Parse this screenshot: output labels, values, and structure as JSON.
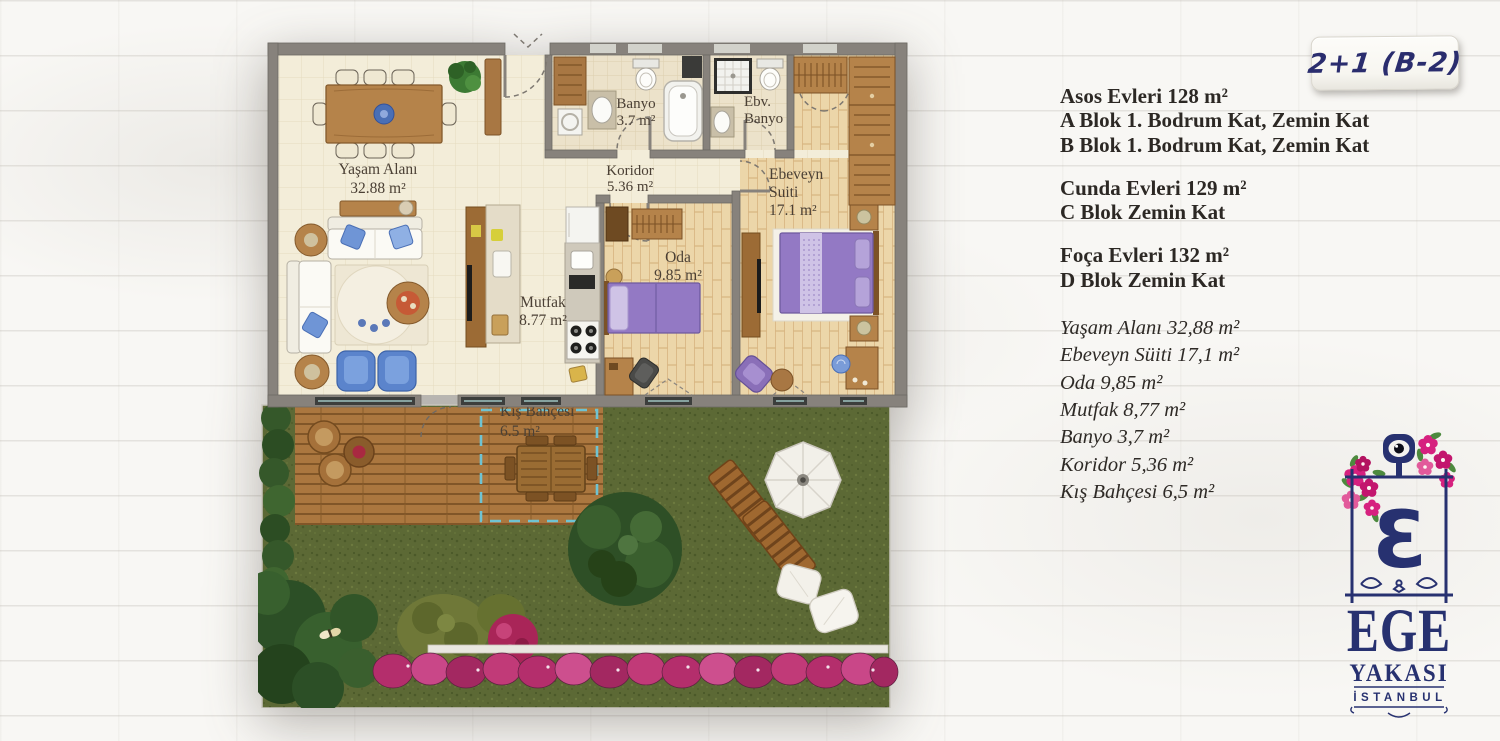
{
  "badge": {
    "label": "2+1 (B-2)"
  },
  "info": {
    "asos": {
      "title": "Asos Evleri 128 m²",
      "line1": "A Blok 1. Bodrum Kat, Zemin Kat",
      "line2": "B Blok 1. Bodrum Kat, Zemin Kat"
    },
    "cunda": {
      "title": "Cunda Evleri 129 m²",
      "line1": "C Blok Zemin Kat"
    },
    "foca": {
      "title": "Foça Evleri 132 m²",
      "line1": "D Blok Zemin Kat"
    },
    "areas": [
      "Yaşam Alanı 32,88 m²",
      "Ebeveyn Süiti 17,1 m²",
      "Oda 9,85 m²",
      "Mutfak 8,77 m²",
      "Banyo 3,7 m²",
      "Koridor 5,36 m²",
      "Kış Bahçesi 6,5 m²"
    ]
  },
  "plan": {
    "labels": {
      "yasam": [
        "Yaşam Alanı",
        "32.88 m²"
      ],
      "banyo": [
        "Banyo",
        "3.7 m²"
      ],
      "ebv_banyo": [
        "Ebv.",
        "Banyo"
      ],
      "koridor": [
        "Koridor",
        "5.36 m²"
      ],
      "ebeveyn": [
        "Ebeveyn",
        "Suiti",
        "17.1 m²"
      ],
      "oda": [
        "Oda",
        "9.85 m²"
      ],
      "mutfak": [
        "Mutfak",
        "8.77 m²"
      ],
      "kis_bahcesi": [
        "Kış Bahçesi",
        "6.5 m²"
      ]
    }
  },
  "logo": {
    "monogram": "Ɛ",
    "name_line1": "EGE",
    "name_line2": "YAKASI",
    "city": "İSTANBUL"
  },
  "colors": {
    "navy": "#273170",
    "pink": "#d6217f",
    "wall_gray": "#87827c",
    "grass_green": "#5c6935",
    "floor_cream": "#f3edd9",
    "wood": "#b5834a",
    "bed_purple": "#9379c4",
    "sofa_blue": "#6f95d6"
  }
}
